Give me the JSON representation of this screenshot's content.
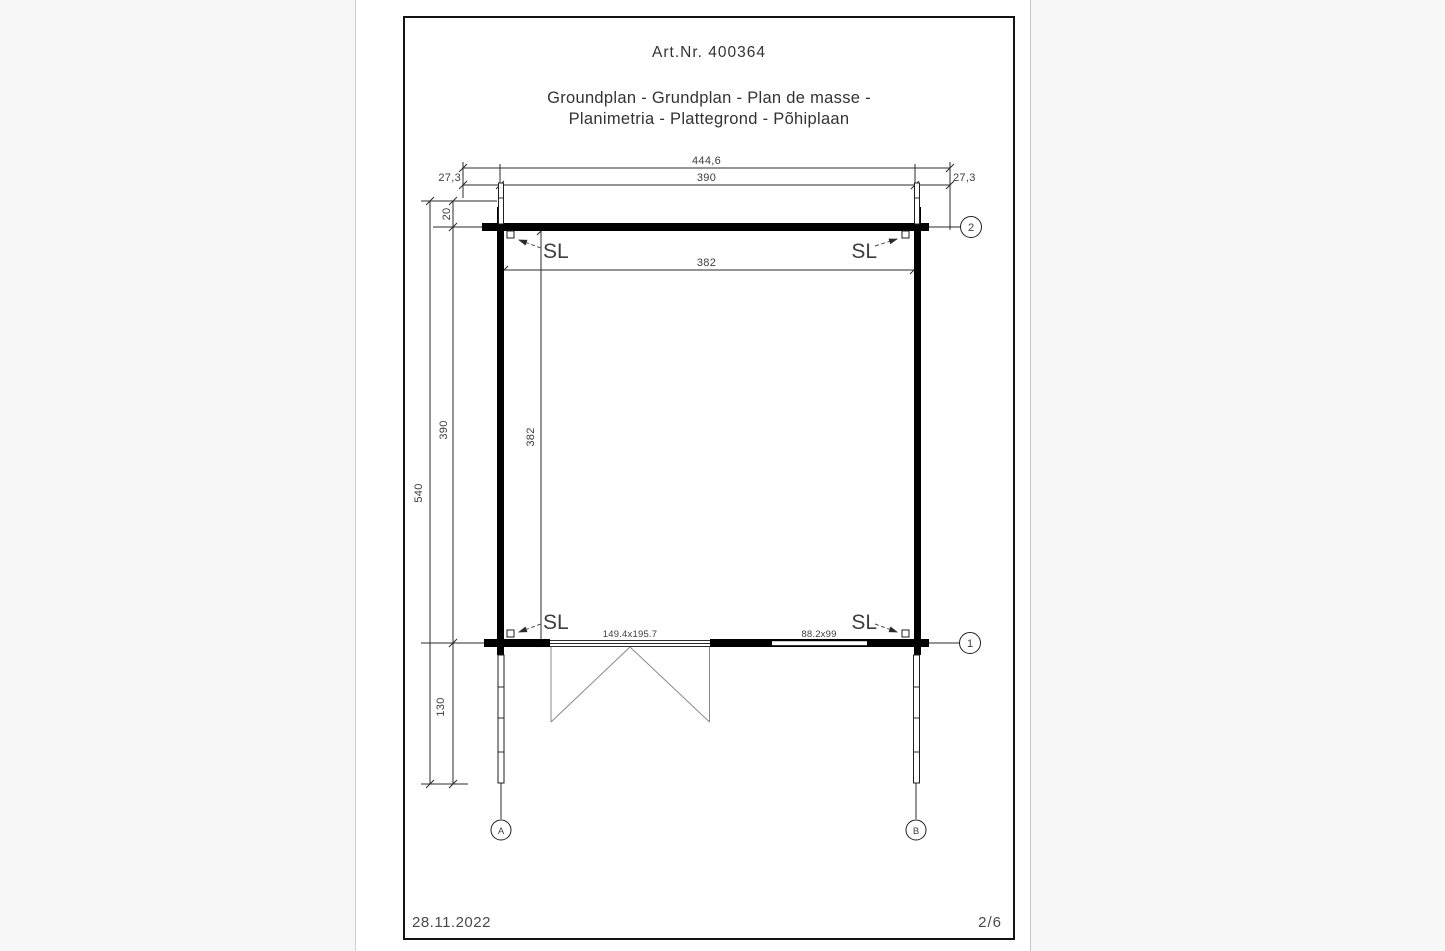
{
  "header": {
    "art_nr": "Art.Nr. 400364",
    "title_line1": "Groundplan - Grundplan - Plan de masse -",
    "title_line2": "Planimetria - Plattegrond - Põhiplaan"
  },
  "dimensions": {
    "overall_width": "444,6",
    "wall_outer_width": "390",
    "overhang_left": "27,3",
    "overhang_right": "27,3",
    "roof_edge_offset": "20",
    "overall_depth": "540",
    "wall_outer_depth": "390",
    "inner_width": "382",
    "inner_depth": "382",
    "canopy_depth": "130",
    "door_opening": "149.4x195.7",
    "window_opening": "88.2x99"
  },
  "markers": {
    "sl_top_left": "SL",
    "sl_top_right": "SL",
    "sl_bottom_left": "SL",
    "sl_bottom_right": "SL"
  },
  "axes": {
    "axis_1": "1",
    "axis_2": "2",
    "axis_a": "A",
    "axis_b": "B"
  },
  "footer": {
    "date": "28.11.2022",
    "page": "2/6"
  },
  "colors": {
    "wall": "#000000",
    "thin_line": "#2b2b2b",
    "door_swing": "#8a8a8a",
    "dim_text": "#3d3d3d",
    "page_bg": "#ffffff",
    "canvas_bg": "#f7f7f7",
    "frame_border": "#141414"
  }
}
